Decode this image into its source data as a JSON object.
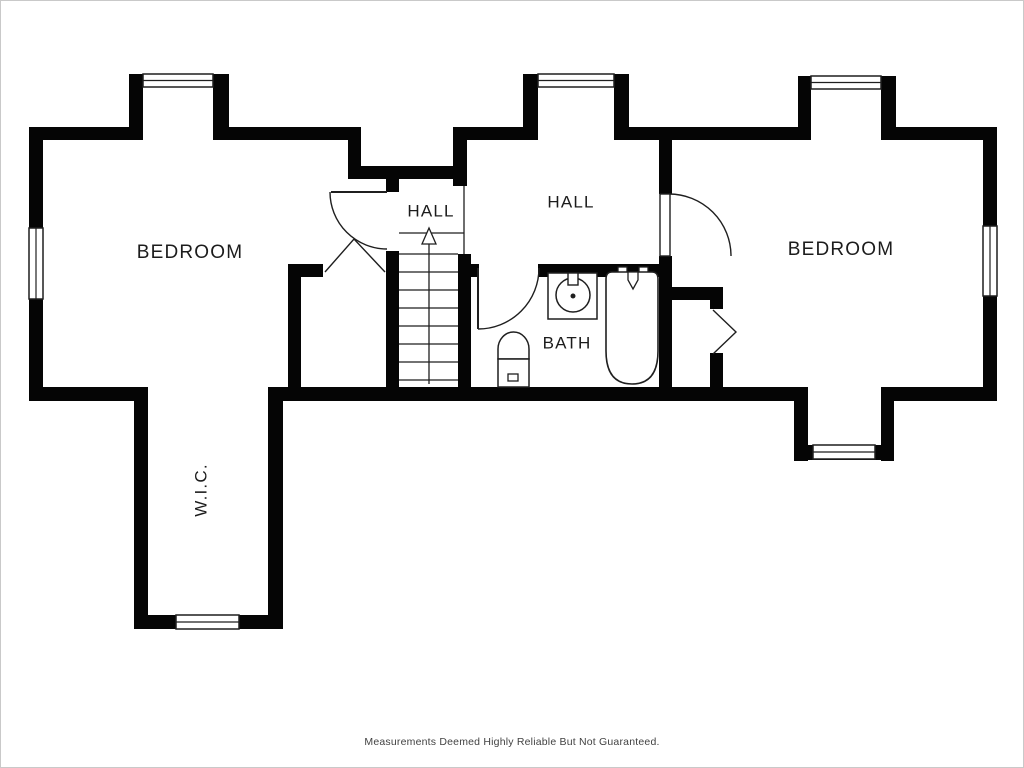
{
  "floorplan": {
    "canvas": {
      "width": 1024,
      "height": 768,
      "background": "#ffffff",
      "frame_color": "#c9c9c9",
      "wall_color": "#050505",
      "line_color": "#1f1f1f",
      "text_color": "#1c1c1c"
    },
    "disclaimer": "Measurements Deemed Highly Reliable But Not Guaranteed.",
    "rooms": [
      {
        "id": "bedroom-left",
        "label": "BEDROOM",
        "x": 189,
        "y": 252,
        "font": 19,
        "rotate": 0
      },
      {
        "id": "hall-small",
        "label": "HALL",
        "x": 430,
        "y": 211,
        "font": 17,
        "rotate": 0
      },
      {
        "id": "hall-main",
        "label": "HALL",
        "x": 570,
        "y": 202,
        "font": 17,
        "rotate": 0
      },
      {
        "id": "bath",
        "label": "BATH",
        "x": 566,
        "y": 343,
        "font": 17,
        "rotate": 0
      },
      {
        "id": "bedroom-right",
        "label": "BEDROOM",
        "x": 840,
        "y": 249,
        "font": 19,
        "rotate": 0
      },
      {
        "id": "wic",
        "label": "W.I.C.",
        "x": 201,
        "y": 489,
        "font": 17,
        "rotate": -90
      }
    ],
    "walls": [
      [
        28,
        126,
        14,
        274
      ],
      [
        28,
        126,
        114,
        13
      ],
      [
        128,
        73,
        14,
        66
      ],
      [
        212,
        73,
        16,
        66
      ],
      [
        228,
        126,
        132,
        13
      ],
      [
        347,
        126,
        13,
        52
      ],
      [
        347,
        165,
        118,
        13
      ],
      [
        452,
        126,
        14,
        59
      ],
      [
        452,
        126,
        85,
        13
      ],
      [
        522,
        73,
        15,
        66
      ],
      [
        613,
        73,
        15,
        66
      ],
      [
        628,
        126,
        169,
        13
      ],
      [
        797,
        75,
        13,
        64
      ],
      [
        880,
        75,
        15,
        64
      ],
      [
        895,
        126,
        101,
        13
      ],
      [
        982,
        126,
        14,
        274
      ],
      [
        385,
        165,
        13,
        26
      ],
      [
        385,
        250,
        13,
        150
      ],
      [
        457,
        253,
        13,
        147
      ],
      [
        470,
        263,
        8,
        13
      ],
      [
        537,
        263,
        134,
        13
      ],
      [
        658,
        126,
        13,
        67
      ],
      [
        658,
        255,
        13,
        145
      ],
      [
        671,
        286,
        51,
        13
      ],
      [
        709,
        299,
        13,
        9
      ],
      [
        709,
        352,
        13,
        48
      ],
      [
        287,
        263,
        13,
        137
      ],
      [
        287,
        263,
        35,
        13
      ],
      [
        28,
        386,
        119,
        14
      ],
      [
        133,
        386,
        14,
        242
      ],
      [
        267,
        386,
        15,
        242
      ],
      [
        133,
        614,
        149,
        14
      ],
      [
        267,
        386,
        540,
        14
      ],
      [
        793,
        386,
        14,
        74
      ],
      [
        880,
        386,
        13,
        74
      ],
      [
        793,
        444,
        100,
        15
      ],
      [
        893,
        386,
        103,
        14
      ]
    ],
    "windows": [
      {
        "name": "window-bedroom-left-dormer",
        "x": 142,
        "y": 73,
        "w": 70,
        "h": 13,
        "orient": "h"
      },
      {
        "name": "window-hall-dormer",
        "x": 537,
        "y": 73,
        "w": 76,
        "h": 13,
        "orient": "h"
      },
      {
        "name": "window-bedroom-right-dormer",
        "x": 810,
        "y": 75,
        "w": 70,
        "h": 13,
        "orient": "h"
      },
      {
        "name": "window-bedroom-right-east",
        "x": 982,
        "y": 225,
        "w": 14,
        "h": 70,
        "orient": "v"
      },
      {
        "name": "window-bedroom-left-west",
        "x": 28,
        "y": 227,
        "w": 14,
        "h": 71,
        "orient": "v"
      },
      {
        "name": "window-wic",
        "x": 175,
        "y": 614,
        "w": 63,
        "h": 14,
        "orient": "h"
      },
      {
        "name": "window-bedroom-right-south",
        "x": 812,
        "y": 444,
        "w": 62,
        "h": 14,
        "orient": "h"
      }
    ],
    "doors": [
      {
        "name": "door-bedroom-left",
        "leaf_line": [
          330,
          191,
          386,
          191
        ],
        "arc": "M 329 191 A 57 57 0 0 0 386 248"
      },
      {
        "name": "door-bath",
        "leaf_line": [
          477,
          267,
          477,
          328
        ],
        "arc": "M 477 328 A 61 61 0 0 0 538 267"
      },
      {
        "name": "door-bedroom-right",
        "leaf_rect": [
          659,
          193,
          10,
          62
        ],
        "arc": "M 668 193 A 62 62 0 0 1 730 255"
      }
    ],
    "bifold_doors": [
      {
        "name": "bifold-closet-left",
        "points": "324,271 353,238 384,271"
      },
      {
        "name": "bifold-closet-right",
        "points": "712,309 735,331 712,353"
      }
    ],
    "stairs": {
      "treads_x1": 398,
      "treads_x2": 457,
      "tread_ys": [
        253,
        271,
        289,
        307,
        325,
        343,
        361,
        379
      ],
      "nosing": [
        398,
        232,
        463,
        232
      ],
      "rail": [
        463,
        185,
        463,
        253
      ],
      "arrow_stem": [
        428,
        243,
        428,
        383
      ],
      "arrow_head": "428,227 421,243 435,243"
    },
    "fixtures": {
      "sink_vanity": {
        "rect": [
          547,
          272,
          49,
          46
        ],
        "basin_cx": 572,
        "basin_cy": 294,
        "basin_r": 17,
        "drain_r": 2.5,
        "faucet": [
          567,
          272,
          10,
          12
        ]
      },
      "toilet": {
        "tank": [
          497,
          358,
          31,
          28
        ],
        "bowl_path": "M 497 358 L 497 348 A 15.5 17 0 0 1 528 348 L 528 358 Z",
        "flush": [
          507,
          373,
          10,
          7
        ]
      },
      "bathtub": {
        "body_path": "M 611 271 L 651 271 Q 657 271 657 278 L 657 350 Q 657 383 631 383 Q 605 383 605 350 L 605 278 Q 605 271 611 271 Z",
        "handle_left": [
          617,
          266,
          9,
          10
        ],
        "handle_right": [
          638,
          266,
          9,
          10
        ],
        "spout": "627,271 637,271 637,279 632,288 627,279"
      }
    }
  }
}
